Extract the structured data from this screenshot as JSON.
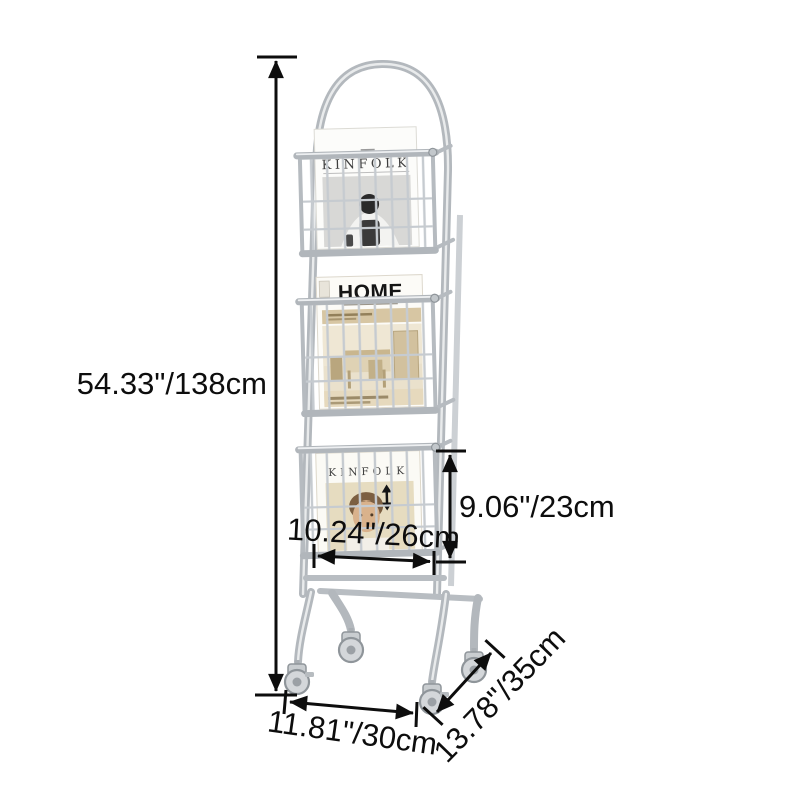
{
  "page": {
    "background": "#ffffff",
    "description": "Product dimension diagram of a rolling magazine rack"
  },
  "product": {
    "kind": "3-tier wire magazine rack with caster wheels",
    "magazines": [
      {
        "position": "top",
        "title": "KINFOLK"
      },
      {
        "position": "middle",
        "title": "HOME"
      },
      {
        "position": "bottom",
        "title": "KINFOLK"
      }
    ]
  },
  "dimensions": {
    "height": "54.33\"/138cm",
    "basket_height": "9.06\"/23cm",
    "basket_width": "10.24\"/26cm",
    "base_width": "11.81\"/30cm",
    "base_depth": "13.78\"/35cm"
  },
  "colors": {
    "annotation": "#0d0d0d",
    "metal": "#b3b8bd",
    "metal_highlight": "#e9ebec",
    "wire": "#c6cbd0",
    "cover_white": "#fbfaf6",
    "cover_beige": "#e7dcc2",
    "photo_gray": "#d8d8d6"
  }
}
